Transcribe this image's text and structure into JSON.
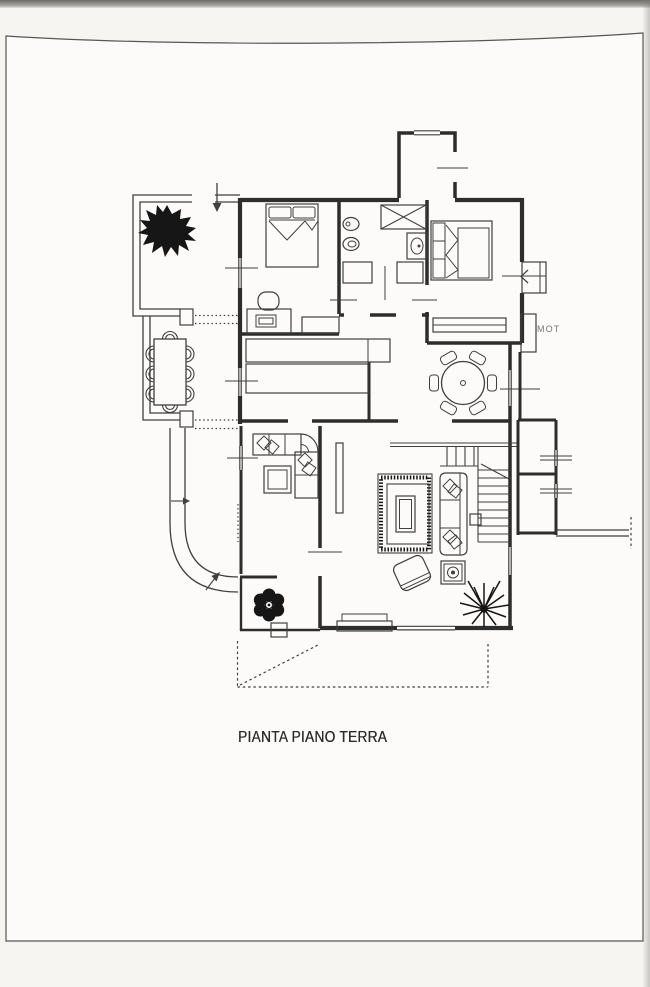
{
  "document": {
    "title": "PIANTA PIANO TERRA",
    "side_label": "MOT"
  },
  "colors": {
    "ink": "#3f3f3f",
    "wall": "#2d2d2d",
    "paper": "#fcfbf9",
    "scan_margin": "#f6f5f2",
    "scanner_edge": "#6e6c66",
    "plant": "#161616"
  }
}
